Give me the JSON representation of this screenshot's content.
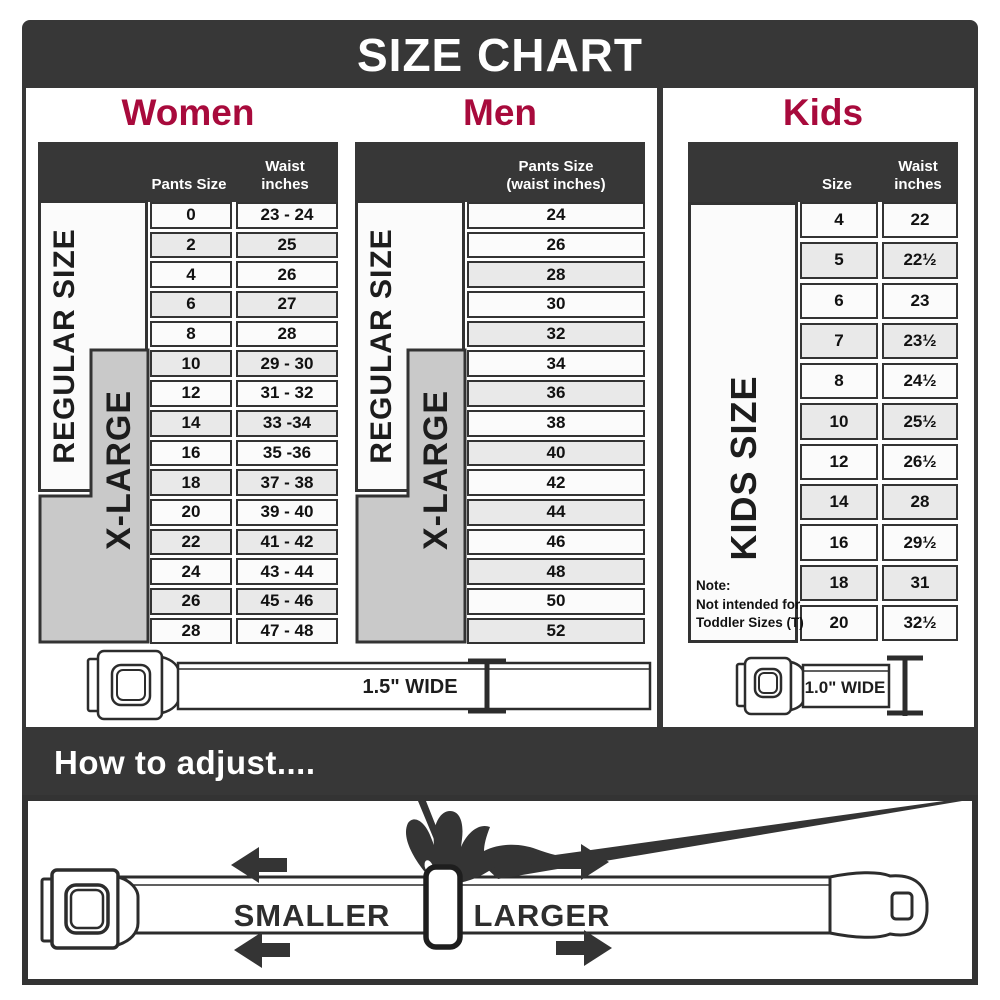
{
  "title": "SIZE CHART",
  "colors": {
    "accent_red": "#a80a3c",
    "bar_dark": "#373737",
    "xlarge_gray": "#c9c9c9"
  },
  "women": {
    "heading": "Women",
    "col_size": "Pants Size",
    "col_waist_line1": "Waist",
    "col_waist_line2": "inches",
    "regular_label": "REGULAR SIZE",
    "xlarge_label": "X-LARGE",
    "rows": [
      {
        "size": "0",
        "waist": "23 - 24"
      },
      {
        "size": "2",
        "waist": "25"
      },
      {
        "size": "4",
        "waist": "26"
      },
      {
        "size": "6",
        "waist": "27"
      },
      {
        "size": "8",
        "waist": "28"
      },
      {
        "size": "10",
        "waist": "29 - 30"
      },
      {
        "size": "12",
        "waist": "31 - 32"
      },
      {
        "size": "14",
        "waist": "33 -34"
      },
      {
        "size": "16",
        "waist": "35 -36"
      },
      {
        "size": "18",
        "waist": "37 - 38"
      },
      {
        "size": "20",
        "waist": "39 - 40"
      },
      {
        "size": "22",
        "waist": "41 - 42"
      },
      {
        "size": "24",
        "waist": "43 - 44"
      },
      {
        "size": "26",
        "waist": "45 - 46"
      },
      {
        "size": "28",
        "waist": "47 - 48"
      }
    ]
  },
  "men": {
    "heading": "Men",
    "col_line1": "Pants Size",
    "col_line2": "(waist inches)",
    "regular_label": "REGULAR SIZE",
    "xlarge_label": "X-LARGE",
    "rows": [
      "24",
      "26",
      "28",
      "30",
      "32",
      "34",
      "36",
      "38",
      "40",
      "42",
      "44",
      "46",
      "48",
      "50",
      "52"
    ]
  },
  "kids": {
    "heading": "Kids",
    "col_size": "Size",
    "col_waist_line1": "Waist",
    "col_waist_line2": "inches",
    "side_label": "KIDS SIZE",
    "note_line1": "Note:",
    "note_line2": "Not intended for",
    "note_line3": "Toddler Sizes (T)",
    "rows": [
      {
        "size": "4",
        "waist": "22"
      },
      {
        "size": "5",
        "waist": "22½"
      },
      {
        "size": "6",
        "waist": "23"
      },
      {
        "size": "7",
        "waist": "23½"
      },
      {
        "size": "8",
        "waist": "24½"
      },
      {
        "size": "10",
        "waist": "25½"
      },
      {
        "size": "12",
        "waist": "26½"
      },
      {
        "size": "14",
        "waist": "28"
      },
      {
        "size": "16",
        "waist": "29½"
      },
      {
        "size": "18",
        "waist": "31"
      },
      {
        "size": "20",
        "waist": "32½"
      }
    ]
  },
  "belts": {
    "adult_width_label": "1.5\" WIDE",
    "kids_width_label": "1.0\" WIDE"
  },
  "adjust": {
    "heading": "How to adjust....",
    "smaller_label": "SMALLER",
    "larger_label": "LARGER"
  }
}
